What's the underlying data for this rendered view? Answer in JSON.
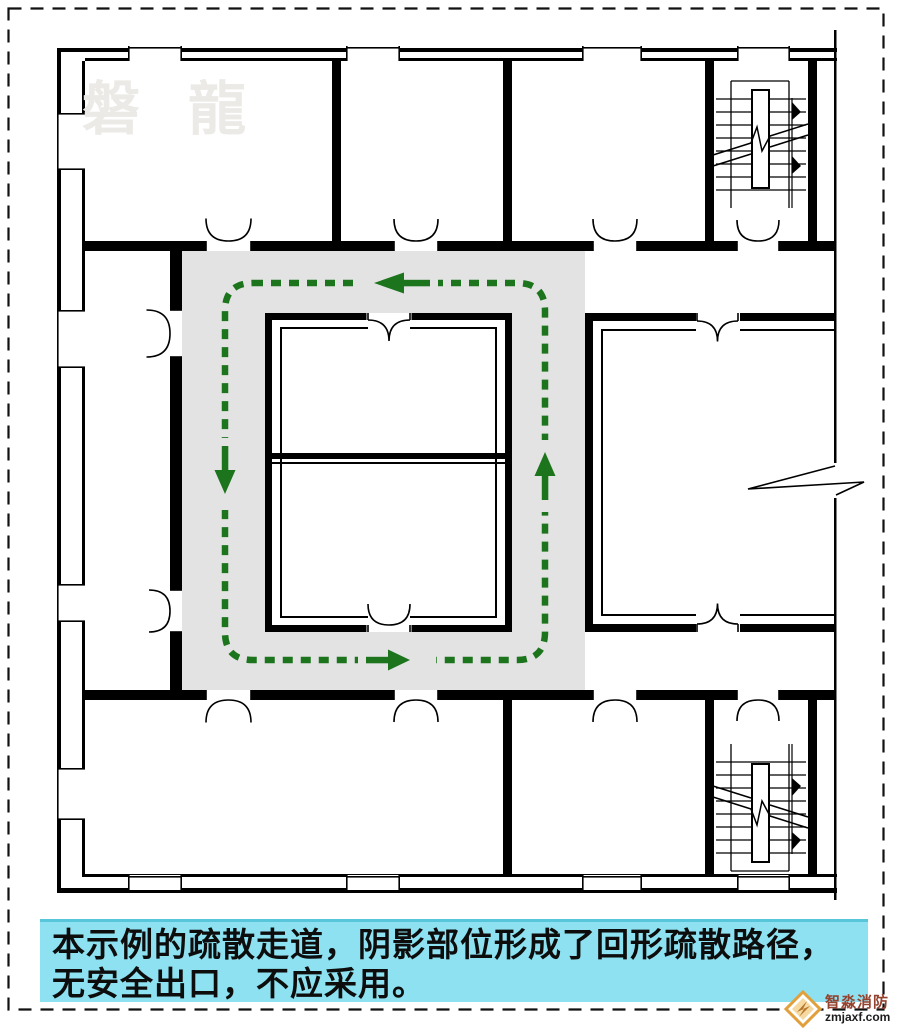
{
  "meta": {
    "type": "architectural-evacuation-plan-diagram"
  },
  "theme": {
    "background": "#ffffff",
    "wall_color": "#000000",
    "shaded_corridor_color": "#e3e3e3",
    "route_color": "#1c741c",
    "caption_bg": "#8de1f0",
    "caption_text_color": "#0d0d0d",
    "watermark_color": "#eceae6",
    "logo_accent": "#e2a03c",
    "logo_name_color": "#94432f",
    "logo_domain_color": "#1c1c1c",
    "border_color": "#111111"
  },
  "watermark": {
    "text": "磐 龍"
  },
  "plan": {
    "shaded_region": "ring-shaped evacuation corridor (shaded)",
    "route": {
      "shape": "closed rectangular dashed loop",
      "arrow_directions": [
        "left (top side)",
        "down (left side)",
        "right (bottom side)",
        "up (right side)"
      ]
    },
    "features": [
      "exterior walls with window openings",
      "staircase top-right",
      "staircase bottom-right",
      "double-swing doors",
      "wall break symbol on right edge"
    ]
  },
  "caption": {
    "line1": "本示例的疏散走道，阴影部位形成了回形疏散路径，",
    "line2": "无安全出口，不应采用。"
  },
  "logo": {
    "name": "智淼消防",
    "domain": "zmjaxf.com",
    "icon": "diamond-bolt-icon"
  }
}
